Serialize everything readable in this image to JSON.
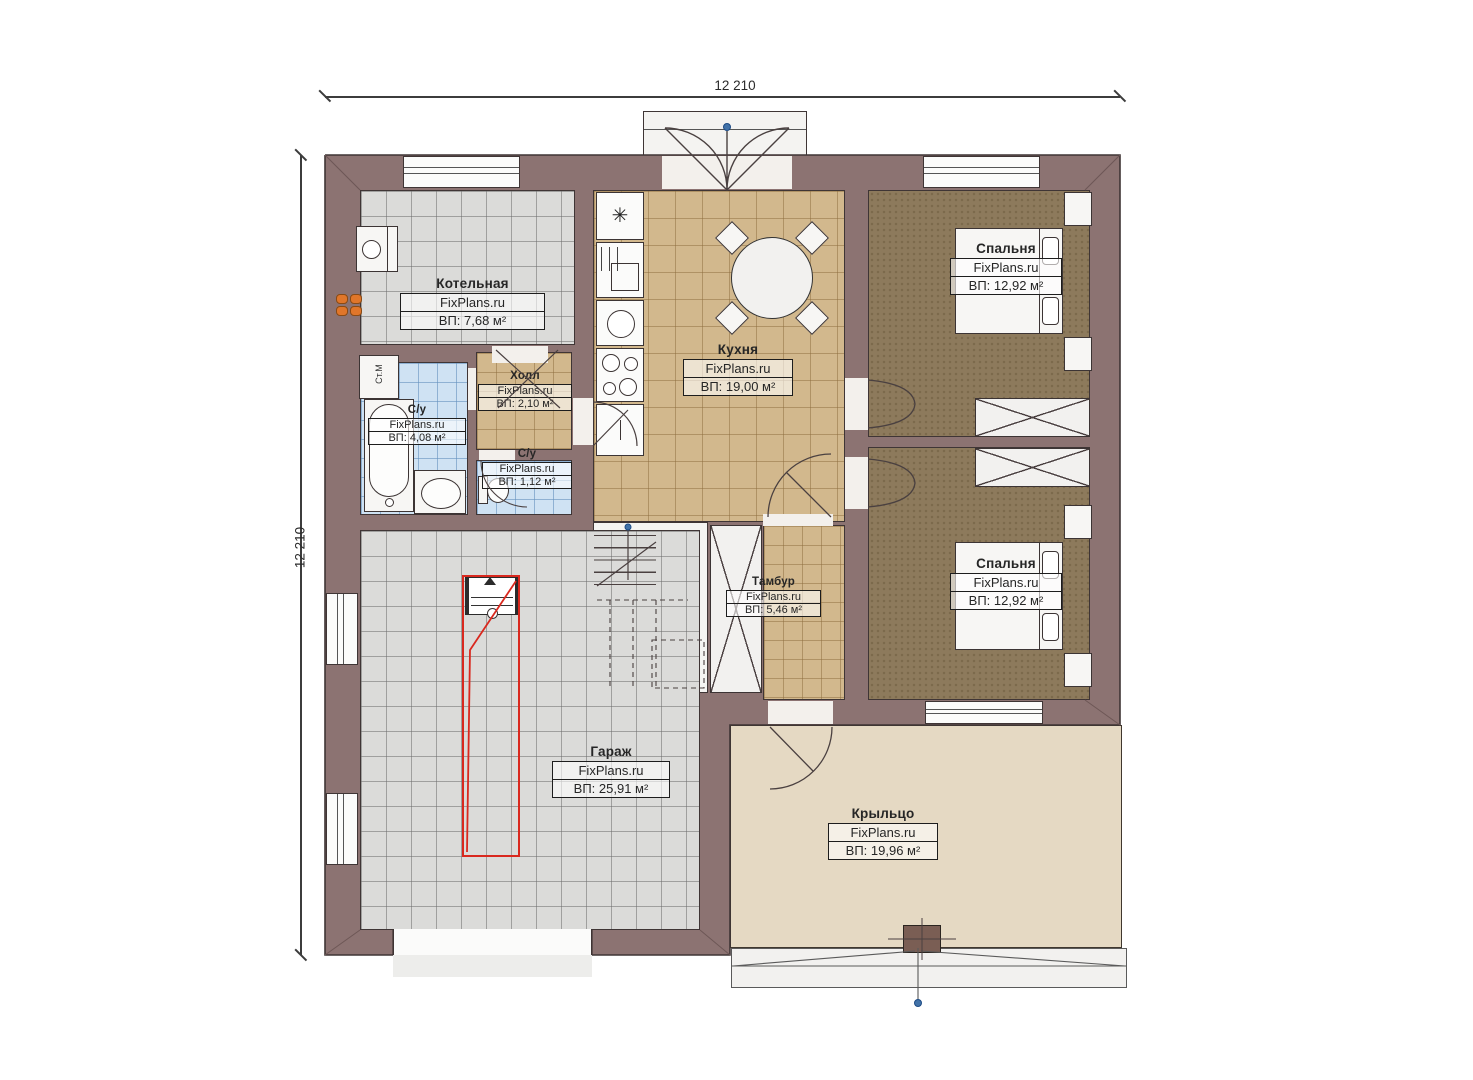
{
  "plan": {
    "dimension_top": "12 210",
    "dimension_left": "12 210",
    "watermark": "FixPlans.ru"
  },
  "rooms": [
    {
      "name": "Котельная",
      "area": "ВП: 7,68 м²"
    },
    {
      "name": "С/у",
      "area": "ВП: 4,08 м²"
    },
    {
      "name": "Холл",
      "area": "ВП: 2,10 м²"
    },
    {
      "name": "С/у",
      "area": "ВП: 1,12 м²"
    },
    {
      "name": "Кухня",
      "area": "ВП: 19,00 м²"
    },
    {
      "name": "Спальня",
      "area": "ВП: 12,92 м²"
    },
    {
      "name": "Спальня",
      "area": "ВП: 12,92 м²"
    },
    {
      "name": "Тамбур",
      "area": "ВП: 5,46 м²"
    },
    {
      "name": "Гараж",
      "area": "ВП: 25,91 м²"
    },
    {
      "name": "Крыльцо",
      "area": "ВП: 19,96 м²"
    }
  ],
  "appliances": {
    "washing_machine": "Ст.М",
    "fridge_symbol": "✳"
  },
  "colors": {
    "wall": "#8c7372",
    "tile_beige": "#d2b88d",
    "tile_gray": "#dbdbd9",
    "tile_blue": "#cfe2f3",
    "floor_brown": "#8d7a5c",
    "porch": "#e5d9c3",
    "car_zone_red": "#d9281e",
    "marker_blue": "#4272a8",
    "radiator_orange": "#e0762a"
  }
}
